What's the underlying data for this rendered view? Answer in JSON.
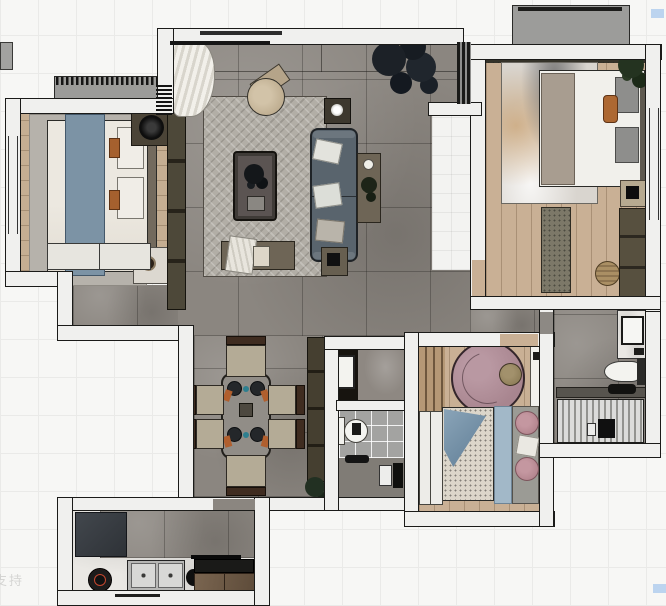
{
  "watermarks": {
    "bottom_left": "支持"
  },
  "palette": {
    "background_tile": "#f7f7f5",
    "wall": "#f0f0ee",
    "wall_outline": "#1b1b19",
    "floor_tile_gray": "#8b8680",
    "floor_wood": "#c5ae92",
    "corridor_tile": "#f3f3f1",
    "rug_herringbone": "#b2aea6",
    "sofa": "#59646d",
    "rug_round_mauve": "#ad8a95",
    "accent_blue_throw": "#7c93a5",
    "accent_orange_pillow": "#ad6832",
    "marble_counter": "#eae8e4",
    "highlight_artifact_blue": "#bcd4ef"
  },
  "rooms": [
    {
      "id": "bedroom-left",
      "furniture": [
        "double-bed",
        "blue-throw",
        "area-rug",
        "lamp-shelf",
        "tray-nightstand",
        "dresser",
        "wardrobe-strip"
      ]
    },
    {
      "id": "living-room",
      "furniture": [
        "herringbone-rug",
        "sofa",
        "coffee-table",
        "round-armchair",
        "side-table-top",
        "side-table-right",
        "bench",
        "corner-table",
        "floor-plant",
        "curtain"
      ]
    },
    {
      "id": "entry-corridor",
      "furniture": [
        "white-tile-floor",
        "glass-window"
      ]
    },
    {
      "id": "bedroom-right",
      "furniture": [
        "double-bed",
        "watercolor-rug",
        "bench-runner",
        "woven-pouf",
        "nightstand",
        "wardrobe",
        "plant",
        "curtain-strip"
      ]
    },
    {
      "id": "balcony",
      "furniture": []
    },
    {
      "id": "dining-room",
      "furniture": [
        "dining-table",
        "chair-top",
        "chair-bottom",
        "chair-left-1",
        "chair-left-2",
        "chair-right-1",
        "chair-right-2",
        "sideboard",
        "plant"
      ]
    },
    {
      "id": "bathroom-middle",
      "furniture": [
        "black-vanity",
        "washbasin",
        "toilet",
        "shower-set"
      ]
    },
    {
      "id": "bedroom-small",
      "furniture": [
        "round-rug",
        "pouf",
        "shelf-desk",
        "bed",
        "blue-blanket",
        "pink-pillows",
        "wardrobe",
        "slat-panel"
      ]
    },
    {
      "id": "bathroom-right",
      "furniture": [
        "marble-vanity",
        "toilet",
        "shower-tray",
        "shower-mixer"
      ]
    },
    {
      "id": "kitchen",
      "furniture": [
        "fridge",
        "gas-burner",
        "double-sink",
        "kettle",
        "pot",
        "range-hood",
        "cooktop",
        "cabinet"
      ]
    }
  ]
}
